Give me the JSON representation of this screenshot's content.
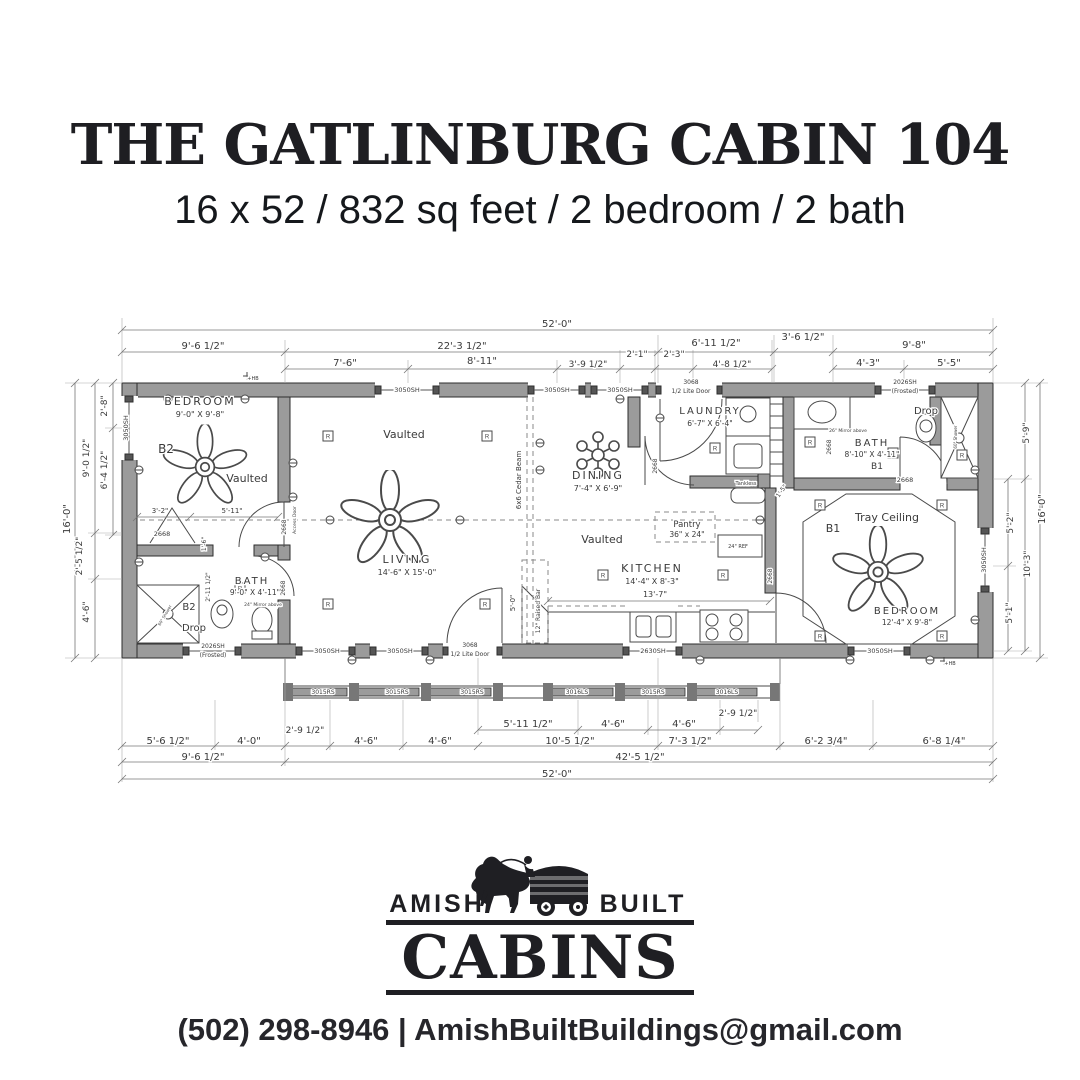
{
  "header": {
    "title": "THE GATLINBURG CABIN 104",
    "subtitle": "16 x 52 / 832 sq feet / 2 bedroom / 2 bath"
  },
  "footer": {
    "brand_left": "AMISH",
    "brand_right": "BUILT",
    "brand_main": "CABINS",
    "contact": "(502) 298-8946 | AmishBuiltBuildings@gmail.com"
  },
  "plan": {
    "colors": {
      "wall": "#9b9b9b",
      "line": "#3d3d3d",
      "dim": "#777777",
      "text": "#3a3a3a"
    },
    "labels": [
      {
        "t": "52'-0\"",
        "x": 557,
        "y": 327,
        "s": 10
      },
      {
        "t": "9'-6 1/2\"",
        "x": 203,
        "y": 349,
        "s": 10
      },
      {
        "t": "22'-3 1/2\"",
        "x": 462,
        "y": 349,
        "s": 10
      },
      {
        "t": "6'-11 1/2\"",
        "x": 716,
        "y": 346,
        "s": 10
      },
      {
        "t": "3'-6 1/2\"",
        "x": 803,
        "y": 340,
        "s": 10
      },
      {
        "t": "9'-8\"",
        "x": 914,
        "y": 348,
        "s": 10
      },
      {
        "t": "7'-6\"",
        "x": 345,
        "y": 366,
        "s": 10
      },
      {
        "t": "8'-11\"",
        "x": 482,
        "y": 364,
        "s": 10
      },
      {
        "t": "3'-9 1/2\"",
        "x": 588,
        "y": 367,
        "s": 9
      },
      {
        "t": "2'-1\"",
        "x": 637,
        "y": 357,
        "s": 9
      },
      {
        "t": "2'-3\"",
        "x": 674,
        "y": 357,
        "s": 9
      },
      {
        "t": "4'-8 1/2\"",
        "x": 732,
        "y": 367,
        "s": 9
      },
      {
        "t": "4'-3\"",
        "x": 868,
        "y": 366,
        "s": 10
      },
      {
        "t": "5'-5\"",
        "x": 949,
        "y": 366,
        "s": 10
      },
      {
        "t": "2'-8\"",
        "x": 107,
        "y": 406,
        "s": 9,
        "r": -90
      },
      {
        "t": "9'-0 1/2\"",
        "x": 89,
        "y": 458,
        "s": 9,
        "r": -90
      },
      {
        "t": "6'-4 1/2\"",
        "x": 107,
        "y": 470,
        "s": 9,
        "r": -90
      },
      {
        "t": "16'-0\"",
        "x": 70,
        "y": 519,
        "s": 10,
        "r": -90
      },
      {
        "t": "2'-5 1/2\"",
        "x": 82,
        "y": 556,
        "s": 9,
        "r": -90
      },
      {
        "t": "4'-6\"",
        "x": 89,
        "y": 612,
        "s": 9,
        "r": -90
      },
      {
        "t": "5'-9\"",
        "x": 1029,
        "y": 433,
        "s": 9,
        "r": -90
      },
      {
        "t": "16'-0\"",
        "x": 1045,
        "y": 509,
        "s": 10,
        "r": -90
      },
      {
        "t": "5'-2\"",
        "x": 1013,
        "y": 523,
        "s": 9,
        "r": -90
      },
      {
        "t": "10'-3\"",
        "x": 1030,
        "y": 564,
        "s": 9,
        "r": -90
      },
      {
        "t": "5'-1\"",
        "x": 1012,
        "y": 613,
        "s": 9,
        "r": -90
      },
      {
        "t": "5'-6 1/2\"",
        "x": 168,
        "y": 744,
        "s": 10
      },
      {
        "t": "4'-0\"",
        "x": 249,
        "y": 744,
        "s": 10
      },
      {
        "t": "2'-9 1/2\"",
        "x": 305,
        "y": 733,
        "s": 9
      },
      {
        "t": "4'-6\"",
        "x": 366,
        "y": 744,
        "s": 10
      },
      {
        "t": "4'-6\"",
        "x": 440,
        "y": 744,
        "s": 10
      },
      {
        "t": "5'-11 1/2\"",
        "x": 528,
        "y": 727,
        "s": 10
      },
      {
        "t": "4'-6\"",
        "x": 613,
        "y": 727,
        "s": 10
      },
      {
        "t": "4'-6\"",
        "x": 684,
        "y": 727,
        "s": 10
      },
      {
        "t": "2'-9 1/2\"",
        "x": 738,
        "y": 716,
        "s": 9
      },
      {
        "t": "10'-5 1/2\"",
        "x": 570,
        "y": 744,
        "s": 10
      },
      {
        "t": "7'-3 1/2\"",
        "x": 690,
        "y": 744,
        "s": 10
      },
      {
        "t": "6'-2 3/4\"",
        "x": 826,
        "y": 744,
        "s": 10
      },
      {
        "t": "6'-8 1/4\"",
        "x": 944,
        "y": 744,
        "s": 10
      },
      {
        "t": "9'-6 1/2\"",
        "x": 203,
        "y": 760,
        "s": 10
      },
      {
        "t": "42'-5 1/2\"",
        "x": 640,
        "y": 760,
        "s": 10
      },
      {
        "t": "52'-0\"",
        "x": 557,
        "y": 777,
        "s": 10
      },
      {
        "t": "BEDROOM",
        "x": 200,
        "y": 405,
        "s": 11,
        "c": "room"
      },
      {
        "t": "9'-0\" X 9'-8\"",
        "x": 200,
        "y": 417,
        "s": 8
      },
      {
        "t": "B2",
        "x": 166,
        "y": 453,
        "s": 12
      },
      {
        "t": "Vaulted",
        "x": 247,
        "y": 482,
        "s": 11
      },
      {
        "t": "Vaulted",
        "x": 404,
        "y": 438,
        "s": 11
      },
      {
        "t": "LIVING",
        "x": 407,
        "y": 563,
        "s": 11,
        "c": "room"
      },
      {
        "t": "14'-6\" X 15'-0\"",
        "x": 407,
        "y": 575,
        "s": 8
      },
      {
        "t": "DINING",
        "x": 598,
        "y": 479,
        "s": 11,
        "c": "room"
      },
      {
        "t": "7'-4\" X 6'-9\"",
        "x": 598,
        "y": 491,
        "s": 8
      },
      {
        "t": "Vaulted",
        "x": 602,
        "y": 543,
        "s": 11
      },
      {
        "t": "LAUNDRY",
        "x": 710,
        "y": 414,
        "s": 10,
        "c": "room"
      },
      {
        "t": "6'-7\" X 6'-4\"",
        "x": 710,
        "y": 426,
        "s": 7.5
      },
      {
        "t": "Pantry",
        "x": 687,
        "y": 527,
        "s": 8.5
      },
      {
        "t": "36\" x 24\"",
        "x": 687,
        "y": 537,
        "s": 7.5
      },
      {
        "t": "KITCHEN",
        "x": 652,
        "y": 572,
        "s": 11,
        "c": "room"
      },
      {
        "t": "14'-4\" X 8'-3\"",
        "x": 652,
        "y": 584,
        "s": 8
      },
      {
        "t": "13'-7\"",
        "x": 655,
        "y": 597,
        "s": 8
      },
      {
        "t": "BATH",
        "x": 252,
        "y": 584,
        "s": 10,
        "c": "room"
      },
      {
        "t": "9'-0\" X 4'-11\"",
        "x": 255,
        "y": 595,
        "s": 7.5
      },
      {
        "t": "B2",
        "x": 189,
        "y": 610,
        "s": 10
      },
      {
        "t": "Drop",
        "x": 194,
        "y": 631,
        "s": 10
      },
      {
        "t": "24\" Mirror above",
        "x": 263,
        "y": 606,
        "s": 4.5
      },
      {
        "t": "BATH",
        "x": 872,
        "y": 446,
        "s": 10,
        "c": "room"
      },
      {
        "t": "8'-10\" X 4'-11\"",
        "x": 872,
        "y": 457,
        "s": 7.5
      },
      {
        "t": "B1",
        "x": 877,
        "y": 469,
        "s": 9
      },
      {
        "t": "Drop",
        "x": 926,
        "y": 414,
        "s": 10
      },
      {
        "t": "26\" Mirror above",
        "x": 848,
        "y": 432,
        "s": 4.5
      },
      {
        "t": "Tray Ceiling",
        "x": 887,
        "y": 521,
        "s": 11
      },
      {
        "t": "B1",
        "x": 833,
        "y": 532,
        "s": 11
      },
      {
        "t": "BEDROOM",
        "x": 907,
        "y": 614,
        "s": 10,
        "c": "room"
      },
      {
        "t": "12'-4\" X 9'-8\"",
        "x": 907,
        "y": 625,
        "s": 7.5
      },
      {
        "t": "Tankless",
        "x": 746,
        "y": 485,
        "s": 5
      },
      {
        "t": "24\" REF",
        "x": 738,
        "y": 548,
        "s": 5
      },
      {
        "t": "6x6 Cedar Beam",
        "x": 521,
        "y": 480,
        "s": 7,
        "r": -90
      },
      {
        "t": "12\" Raised Bar",
        "x": 540,
        "y": 611,
        "s": 6,
        "r": -90
      },
      {
        "t": "5'-0\"",
        "x": 515,
        "y": 603,
        "s": 7,
        "r": -90
      },
      {
        "t": "3'-2\"",
        "x": 160,
        "y": 513,
        "s": 7
      },
      {
        "t": "5'-11\"",
        "x": 232,
        "y": 513,
        "s": 7
      },
      {
        "t": "1'-6\"",
        "x": 206,
        "y": 544,
        "s": 6,
        "r": -90
      },
      {
        "t": "2'-11 1/2\"",
        "x": 210,
        "y": 587,
        "s": 6,
        "r": -90
      },
      {
        "t": "1'-5\"",
        "x": 783,
        "y": 492,
        "s": 6,
        "r": -55
      },
      {
        "t": "Access Door",
        "x": 296,
        "y": 520,
        "s": 4.5,
        "r": -90
      },
      {
        "t": "2668",
        "x": 286,
        "y": 527,
        "s": 6,
        "r": -90
      },
      {
        "t": "2668",
        "x": 162,
        "y": 536,
        "s": 6.5
      },
      {
        "t": "2668",
        "x": 285,
        "y": 588,
        "s": 6,
        "r": -90
      },
      {
        "t": "2668",
        "x": 657,
        "y": 466,
        "s": 6,
        "r": -90
      },
      {
        "t": "2668",
        "x": 772,
        "y": 576,
        "s": 6,
        "r": -90
      },
      {
        "t": "2668",
        "x": 905,
        "y": 482,
        "s": 6.5
      },
      {
        "t": "2668",
        "x": 831,
        "y": 447,
        "s": 6,
        "r": -90
      },
      {
        "t": "60\" Shower",
        "x": 166,
        "y": 616,
        "s": 4,
        "r": -60
      },
      {
        "t": "60\" Shower",
        "x": 957,
        "y": 437,
        "s": 4,
        "r": -90
      },
      {
        "t": "3050SH",
        "x": 407,
        "y": 392,
        "s": 6.5
      },
      {
        "t": "3050SH",
        "x": 557,
        "y": 392,
        "s": 6.5
      },
      {
        "t": "3050SH",
        "x": 620,
        "y": 392,
        "s": 6.5
      },
      {
        "t": "3068",
        "x": 691,
        "y": 384,
        "s": 6
      },
      {
        "t": "1/2 Lite Door",
        "x": 691,
        "y": 393,
        "s": 6
      },
      {
        "t": "2026SH",
        "x": 905,
        "y": 384,
        "s": 6
      },
      {
        "t": "(Frosted)",
        "x": 905,
        "y": 393,
        "s": 6
      },
      {
        "t": "3050SH",
        "x": 128,
        "y": 428,
        "s": 6.5,
        "r": -90
      },
      {
        "t": "3050SH",
        "x": 986,
        "y": 560,
        "s": 6.5,
        "r": -90
      },
      {
        "t": "2026SH",
        "x": 213,
        "y": 648,
        "s": 6
      },
      {
        "t": "(Frosted)",
        "x": 213,
        "y": 657,
        "s": 6
      },
      {
        "t": "3050SH",
        "x": 327,
        "y": 653,
        "s": 6.5
      },
      {
        "t": "3050SH",
        "x": 400,
        "y": 653,
        "s": 6.5
      },
      {
        "t": "3068",
        "x": 470,
        "y": 647,
        "s": 6
      },
      {
        "t": "1/2 Lite Door",
        "x": 470,
        "y": 656,
        "s": 6
      },
      {
        "t": "2630SH",
        "x": 653,
        "y": 653,
        "s": 6.5
      },
      {
        "t": "3050SH",
        "x": 880,
        "y": 653,
        "s": 6.5
      },
      {
        "t": "3015RS",
        "x": 323,
        "y": 694,
        "s": 6
      },
      {
        "t": "3015RS",
        "x": 397,
        "y": 694,
        "s": 6
      },
      {
        "t": "3015RS",
        "x": 472,
        "y": 694,
        "s": 6
      },
      {
        "t": "3016LS",
        "x": 577,
        "y": 694,
        "s": 6
      },
      {
        "t": "3015RS",
        "x": 653,
        "y": 694,
        "s": 6
      },
      {
        "t": "3016LS",
        "x": 727,
        "y": 694,
        "s": 6
      },
      {
        "t": "+HB",
        "x": 253,
        "y": 380,
        "s": 5
      },
      {
        "t": "+HB",
        "x": 950,
        "y": 665,
        "s": 5
      }
    ],
    "dims": [
      {
        "o": "h",
        "pos": 330,
        "pts": [
          122,
          993
        ]
      },
      {
        "o": "h",
        "pos": 352,
        "pts": [
          122,
          285,
          658,
          774,
          833,
          993
        ]
      },
      {
        "o": "h",
        "pos": 369,
        "pts": [
          285,
          408,
          557,
          620,
          655,
          693,
          772
        ]
      },
      {
        "o": "h",
        "pos": 369,
        "pts": [
          833,
          904,
          993
        ]
      },
      {
        "o": "v",
        "pos": 75,
        "pts": [
          383,
          658
        ]
      },
      {
        "o": "v",
        "pos": 95,
        "pts": [
          383,
          533,
          579,
          658
        ]
      },
      {
        "o": "v",
        "pos": 113,
        "pts": [
          383,
          428,
          535
        ]
      },
      {
        "o": "v",
        "pos": 1040,
        "pts": [
          383,
          658
        ]
      },
      {
        "o": "v",
        "pos": 1025,
        "pts": [
          383,
          479,
          651
        ]
      },
      {
        "o": "v",
        "pos": 1008,
        "pts": [
          479,
          566,
          651
        ]
      },
      {
        "o": "h",
        "pos": 730,
        "pts": [
          478,
          578,
          648,
          720,
          758
        ]
      },
      {
        "o": "h",
        "pos": 746,
        "pts": [
          122,
          215,
          285,
          330,
          403,
          478,
          658,
          780
        ]
      },
      {
        "o": "h",
        "pos": 746,
        "pts": [
          780,
          873,
          993
        ]
      },
      {
        "o": "h",
        "pos": 762,
        "pts": [
          122,
          285,
          993
        ]
      },
      {
        "o": "h",
        "pos": 779,
        "pts": [
          122,
          993
        ]
      },
      {
        "o": "h",
        "pos": 601,
        "pts": [
          548,
          770
        ]
      },
      {
        "o": "h",
        "pos": 517,
        "pts": [
          137,
          190,
          278
        ]
      }
    ],
    "lights": [
      [
        328,
        436
      ],
      [
        487,
        436
      ],
      [
        328,
        604
      ],
      [
        485,
        604
      ],
      [
        603,
        575
      ],
      [
        723,
        575
      ],
      [
        715,
        448
      ],
      [
        810,
        442
      ],
      [
        893,
        453
      ],
      [
        962,
        455
      ],
      [
        820,
        505
      ],
      [
        942,
        505
      ],
      [
        820,
        636
      ],
      [
        942,
        636
      ],
      [
        240,
        588
      ]
    ],
    "outlets": [
      [
        168,
        399
      ],
      [
        245,
        399
      ],
      [
        293,
        463
      ],
      [
        293,
        497
      ],
      [
        352,
        660
      ],
      [
        430,
        660
      ],
      [
        540,
        470
      ],
      [
        540,
        443
      ],
      [
        620,
        399
      ],
      [
        660,
        418
      ],
      [
        700,
        660
      ],
      [
        760,
        520
      ],
      [
        850,
        660
      ],
      [
        930,
        660
      ],
      [
        975,
        470
      ],
      [
        975,
        620
      ],
      [
        139,
        470
      ],
      [
        139,
        562
      ],
      [
        265,
        557
      ],
      [
        460,
        520
      ],
      [
        330,
        520
      ]
    ],
    "fans": [
      [
        205,
        467,
        0.85
      ],
      [
        390,
        520,
        1.0
      ],
      [
        878,
        572,
        0.92
      ]
    ],
    "chandeliers": [
      [
        598,
        455
      ]
    ]
  }
}
